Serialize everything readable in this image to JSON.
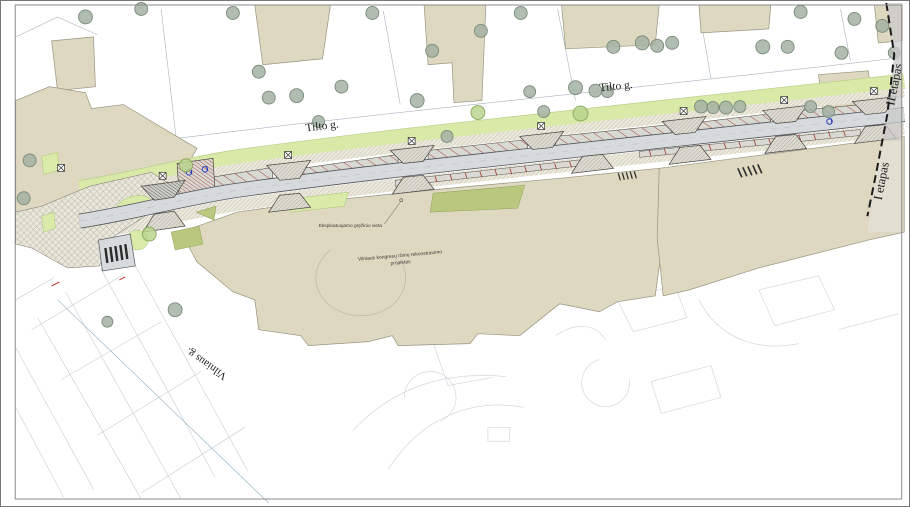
{
  "labels": {
    "tilto_1": "Tilto g.",
    "tilto_2": "Tilto g.",
    "vilniaus": "Vilniaus g.",
    "stage_i": "I etapas",
    "stage_ii": "II etapas",
    "borehole": "Eksploatuojamo gręžinio vieta",
    "project_line1": "Vilniaus kongresų rūmų rekonstravimo",
    "project_line2": "projektas"
  },
  "map": {
    "type": "street-reconstruction-site-plan",
    "streets": [
      "Tilto g.",
      "Vilniaus g."
    ],
    "stages": [
      "I etapas",
      "II etapas"
    ],
    "annotations": [
      "Eksploatuojamo gręžinio vieta",
      "Vilniaus kongresų rūmų rekonstravimo projektas"
    ]
  },
  "colors": {
    "building_fill": "#ded8c0",
    "lawn_green": "#d9e9a8",
    "olive_green": "#b9c87e",
    "road_gray": "#d7dadc",
    "sidewalk_hatch": "#ebe8dc",
    "stall_red": "#a03028",
    "disabled_blue": "#2236c0",
    "tree_gray": "#a3b1a3",
    "stage_line_black": "#1a1a1a",
    "faint_line": "#c7ccd2"
  }
}
